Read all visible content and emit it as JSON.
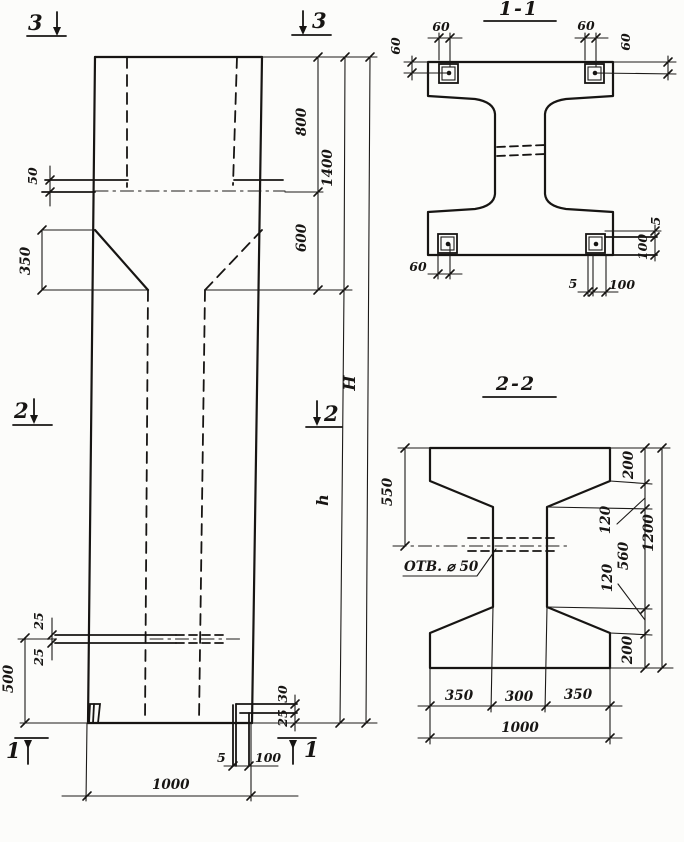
{
  "sheet": {
    "type": "reinforced-concrete-column working drawing",
    "ink_color": "#171513",
    "paper_color": "#fcfcfa"
  },
  "elevation": {
    "markers": {
      "s3_left": "3",
      "s3_right": "3",
      "s2_left": "2",
      "s2_right": "2",
      "s1_left": "1",
      "s1_right": "1"
    },
    "dims": {
      "ledge": "50",
      "taper": "350",
      "top_recess": "800",
      "neck": "600",
      "upper_total": "1400",
      "total_height": "H",
      "shaft_height": "h",
      "slot_upper": "25",
      "slot_lower": "25",
      "base_zone": "500",
      "foot_upper": "30",
      "foot_lower": "25",
      "foot_plate": "5",
      "foot_width": "100",
      "base_width": "1000"
    }
  },
  "section_1_1": {
    "title": "1-1",
    "dims": {
      "tl_h": "60",
      "tl_v": "60",
      "tr_h": "60",
      "tr_v": "60",
      "bl": "60",
      "br_5": "5",
      "br_100": "100",
      "r_5": "5",
      "r_100": "100"
    }
  },
  "section_2_2": {
    "title": "2-2",
    "hole_label": "ОТВ. ⌀ 50",
    "dims": {
      "web_top": "550",
      "flange_top": "200",
      "haunch_top": "120",
      "web": "560",
      "haunch_bot": "120",
      "overall": "1200",
      "flange_bot": "200",
      "bottom_left": "350",
      "bottom_mid": "300",
      "bottom_right": "350",
      "width": "1000"
    }
  }
}
